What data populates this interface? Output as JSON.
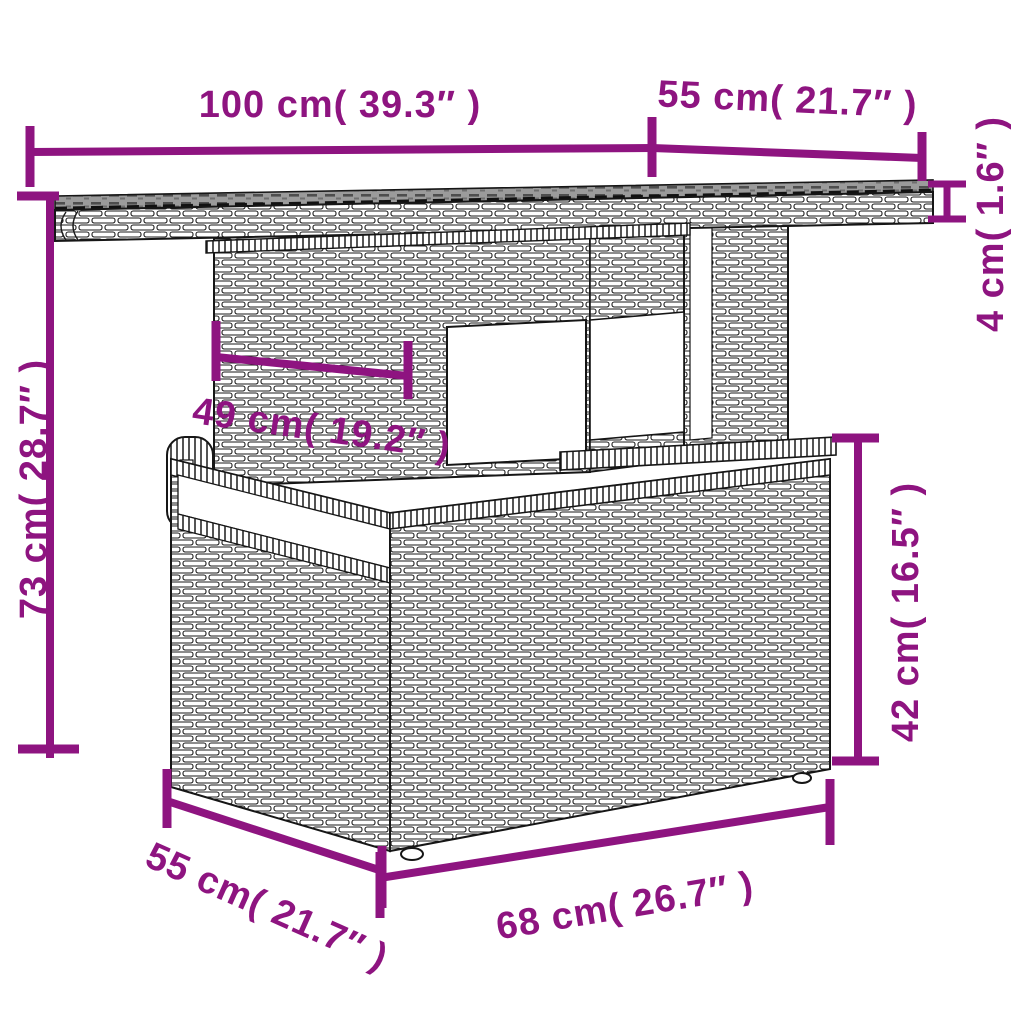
{
  "diagram": {
    "type": "product-dimension-diagram",
    "subject": "poly-rattan-outdoor-table-line-drawing",
    "colors": {
      "accent": "#8E1480",
      "line_art": "#161616",
      "glass_top": "#9b9b9b",
      "background": "#ffffff"
    },
    "dimensions": {
      "top_width": {
        "label": "100 cm( 39.3″ )",
        "value_cm": 100,
        "value_in": 39.3
      },
      "top_depth": {
        "label": "55 cm( 21.7″ )",
        "value_cm": 55,
        "value_in": 21.7
      },
      "top_thickness": {
        "label": "4 cm( 1.6″ )",
        "value_cm": 4,
        "value_in": 1.6
      },
      "total_height": {
        "label": "73 cm( 28.7″ )",
        "value_cm": 73,
        "value_in": 28.7
      },
      "pedestal_width": {
        "label": "49 cm( 19.2″ )",
        "value_cm": 49,
        "value_in": 19.2
      },
      "base_height": {
        "label": "42 cm( 16.5″ )",
        "value_cm": 42,
        "value_in": 16.5
      },
      "base_width": {
        "label": "68 cm( 26.7″ )",
        "value_cm": 68,
        "value_in": 26.7
      },
      "base_depth": {
        "label": "55 cm( 21.7″ )",
        "value_cm": 55,
        "value_in": 21.7
      }
    }
  }
}
